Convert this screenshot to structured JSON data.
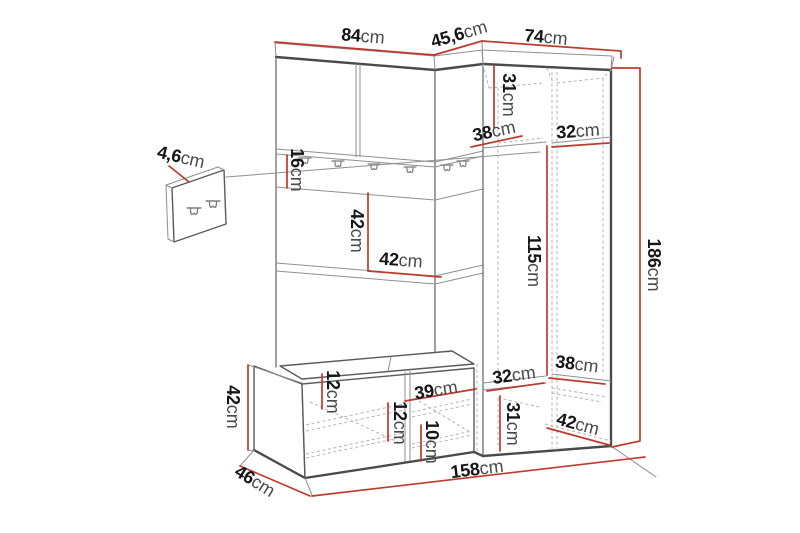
{
  "diagram": {
    "type": "furniture-dimension-diagram",
    "subject": "hallway wardrobe set with bench and wall hook panel",
    "unit": "cm"
  },
  "colors": {
    "dimension_line": "#bf3a2b",
    "outline": "#4a4a4a",
    "inner_line": "#6d6d6d",
    "hidden_line": "#b3b3b3",
    "label_number": "#161616",
    "label_unit": "#4a4a4a",
    "background": "#ffffff"
  },
  "icons": {
    "coat_hook": "double-coat-hook"
  },
  "dims": {
    "left_top_width": {
      "value": "84",
      "unit": "cm"
    },
    "corner_top_width": {
      "value": "45,6",
      "unit": "cm"
    },
    "right_top_width": {
      "value": "74",
      "unit": "cm"
    },
    "panel_depth": {
      "value": "4,6",
      "unit": "cm"
    },
    "hook_rail_height": {
      "value": "16",
      "unit": "cm"
    },
    "open_section_height": {
      "value": "42",
      "unit": "cm"
    },
    "open_section_width": {
      "value": "42",
      "unit": "cm"
    },
    "top_shelf_height": {
      "value": "31",
      "unit": "cm"
    },
    "top_shelf_depth": {
      "value": "38",
      "unit": "cm"
    },
    "top_shelf_width": {
      "value": "32",
      "unit": "cm"
    },
    "hanging_space_height": {
      "value": "115",
      "unit": "cm"
    },
    "total_height": {
      "value": "186",
      "unit": "cm"
    },
    "bottom_shelf_depth": {
      "value": "38",
      "unit": "cm"
    },
    "bottom_shelf_width": {
      "value": "32",
      "unit": "cm"
    },
    "bottom_shelf_height": {
      "value": "31",
      "unit": "cm"
    },
    "wardrobe_bottom_depth": {
      "value": "42",
      "unit": "cm"
    },
    "bench_height": {
      "value": "42",
      "unit": "cm"
    },
    "bench_depth": {
      "value": "46",
      "unit": "cm"
    },
    "bench_top_offset": {
      "value": "12",
      "unit": "cm"
    },
    "bench_shelf_spacing": {
      "value": "12",
      "unit": "cm"
    },
    "bench_compartment_width": {
      "value": "39",
      "unit": "cm"
    },
    "bench_shelf_height": {
      "value": "10",
      "unit": "cm"
    },
    "total_width": {
      "value": "158",
      "unit": "cm"
    }
  }
}
